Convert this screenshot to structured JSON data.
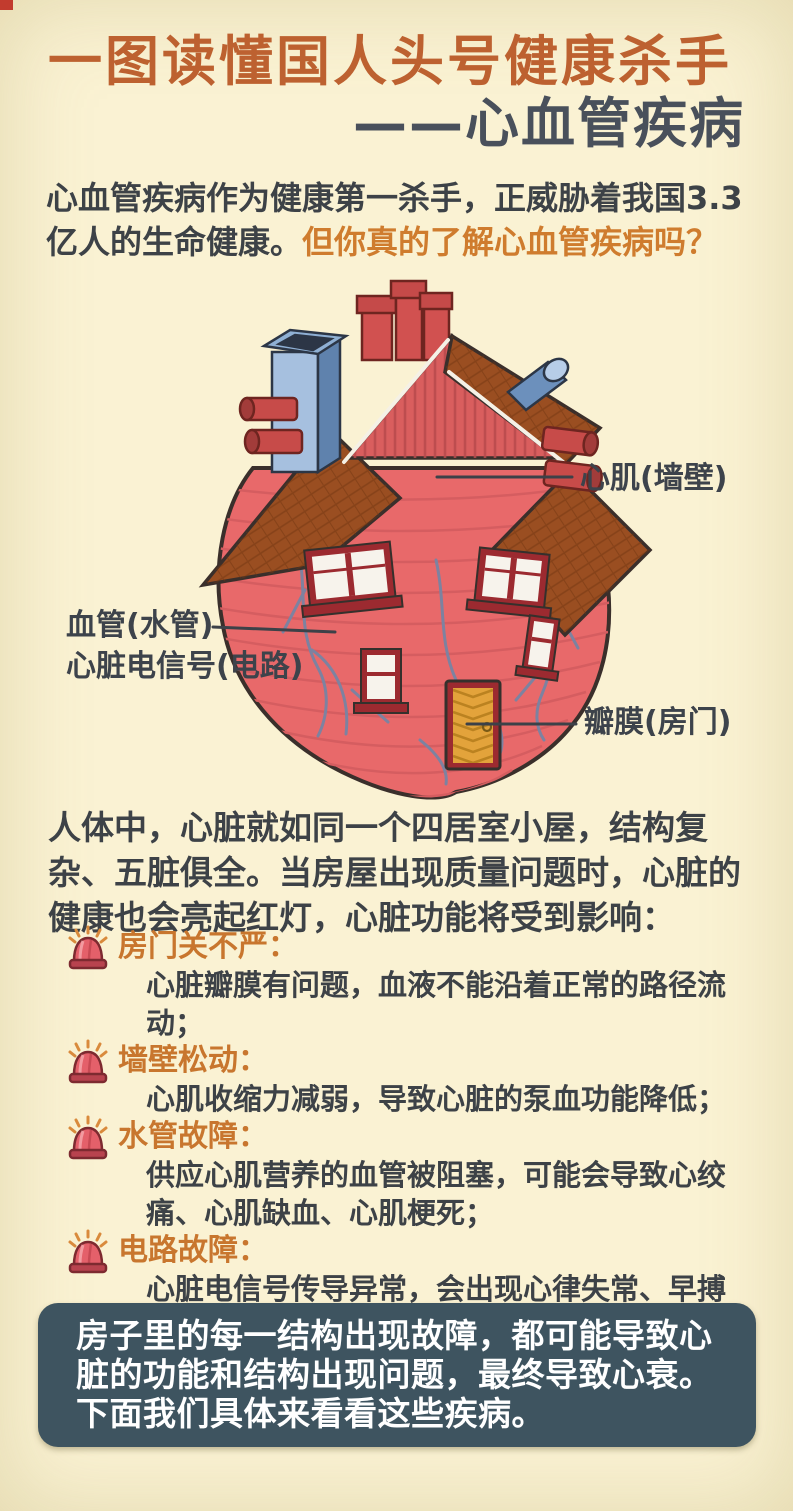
{
  "title": {
    "line1": "一图读懂国人头号健康杀手",
    "line2": "——心血管疾病"
  },
  "intro": {
    "dark": "心血管疾病作为健康第一杀手，正威胁着我国3.3亿人的生命健康。",
    "highlight": "但你真的了解心血管疾病吗？"
  },
  "diagram": {
    "labels": {
      "myocardium": "心肌(墙壁)",
      "vessel": "血管(水管)",
      "signal": "心脏电信号(电路)",
      "valve": "瓣膜(房门)"
    }
  },
  "paragraph": "人体中，心脏就如同一个四居室小屋，结构复杂、五脏俱全。当房屋出现质量问题时，心脏的健康也会亮起红灯，心脏功能将受到影响：",
  "issues": [
    {
      "title": "房门关不严：",
      "desc": "心脏瓣膜有问题，血液不能沿着正常的路径流动；"
    },
    {
      "title": "墙壁松动：",
      "desc": "心肌收缩力减弱，导致心脏的泵血功能降低；"
    },
    {
      "title": "水管故障：",
      "desc": "供应心肌营养的血管被阻塞，可能会导致心绞痛、心肌缺血、心肌梗死；"
    },
    {
      "title": "电路故障：",
      "desc": "心脏电信号传导异常，会出现心律失常、早搏等。"
    }
  ],
  "footer": {
    "text": "房子里的每一结构出现故障，都可能导致心脏的功能和结构出现问题，最终导致心衰。下面我们具体来看看这些疾病。"
  },
  "colors": {
    "page_bg": "#faf2d3",
    "title_orange": "#bd6130",
    "title_dark": "#49505b",
    "highlight_orange": "#cf7c2e",
    "text_dark": "#3d4247",
    "issue_head_orange": "#c8762e",
    "footer_bg": "#3e5460",
    "footer_text": "#ffffff",
    "heart_red": "#e8696a",
    "roof_brown": "#9a4e21",
    "door_yellow": "#e3a33b",
    "vein_gray": "#7d82a0",
    "alarm_red": "#e4606a",
    "blue_chimney": "#a6c0df"
  }
}
